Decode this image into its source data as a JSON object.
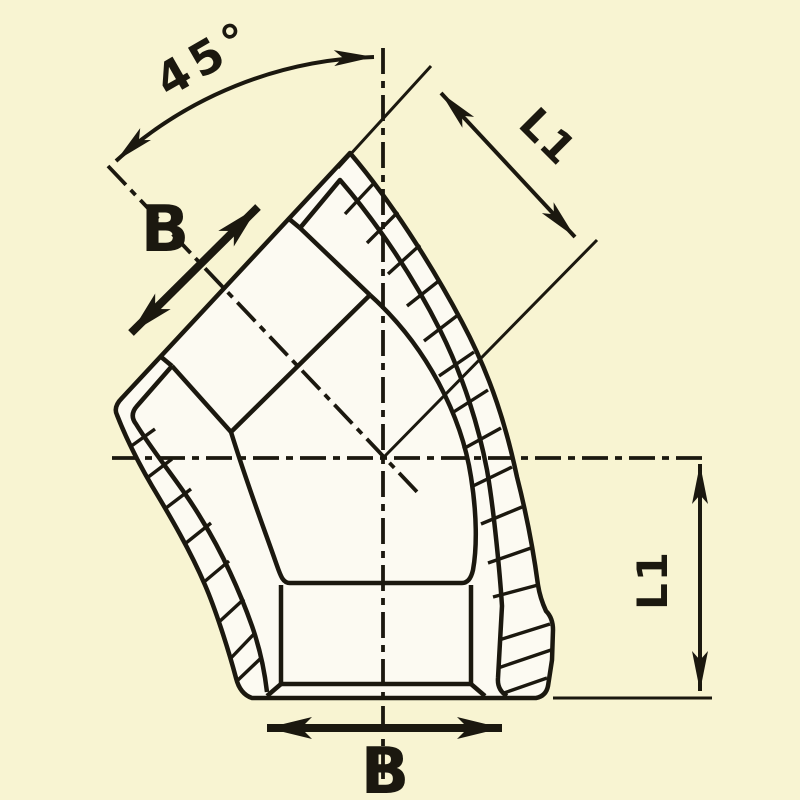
{
  "drawing": {
    "angle_label": "45°",
    "labels": {
      "b_top": "B",
      "b_bottom": "B",
      "l1_diagonal": "L1",
      "l1_vertical": "L1"
    },
    "colors": {
      "background": "#f8f4d2",
      "body_fill": "#fcfaf2",
      "line": "#1b180f"
    }
  }
}
